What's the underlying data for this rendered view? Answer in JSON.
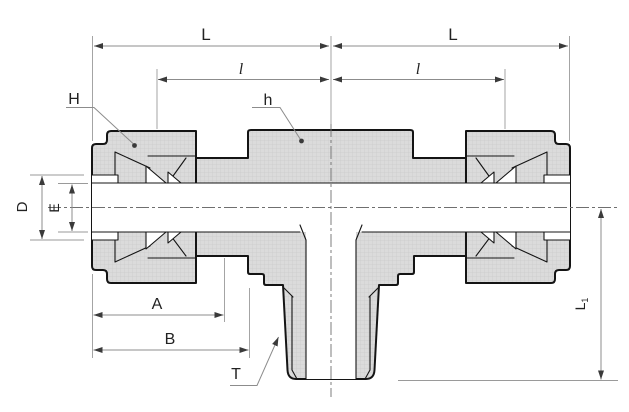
{
  "drawing": {
    "labels": {
      "length_left": "L",
      "length_right": "L",
      "ferrule_length_left": "l",
      "ferrule_length_right": "l",
      "nut_hex": "H",
      "body_hex": "h",
      "hole_dia": "D",
      "bore_dia": "E",
      "dim_a": "A",
      "dim_b": "B",
      "thread": "T",
      "branch_len_main": "L",
      "branch_len_sub": "1"
    },
    "colors": {
      "background": "#ffffff",
      "part_fill": "#dbdbdb",
      "part_outline": "#141414",
      "dimension_lines": "#8c8c8c",
      "label_text": "#222222"
    }
  }
}
